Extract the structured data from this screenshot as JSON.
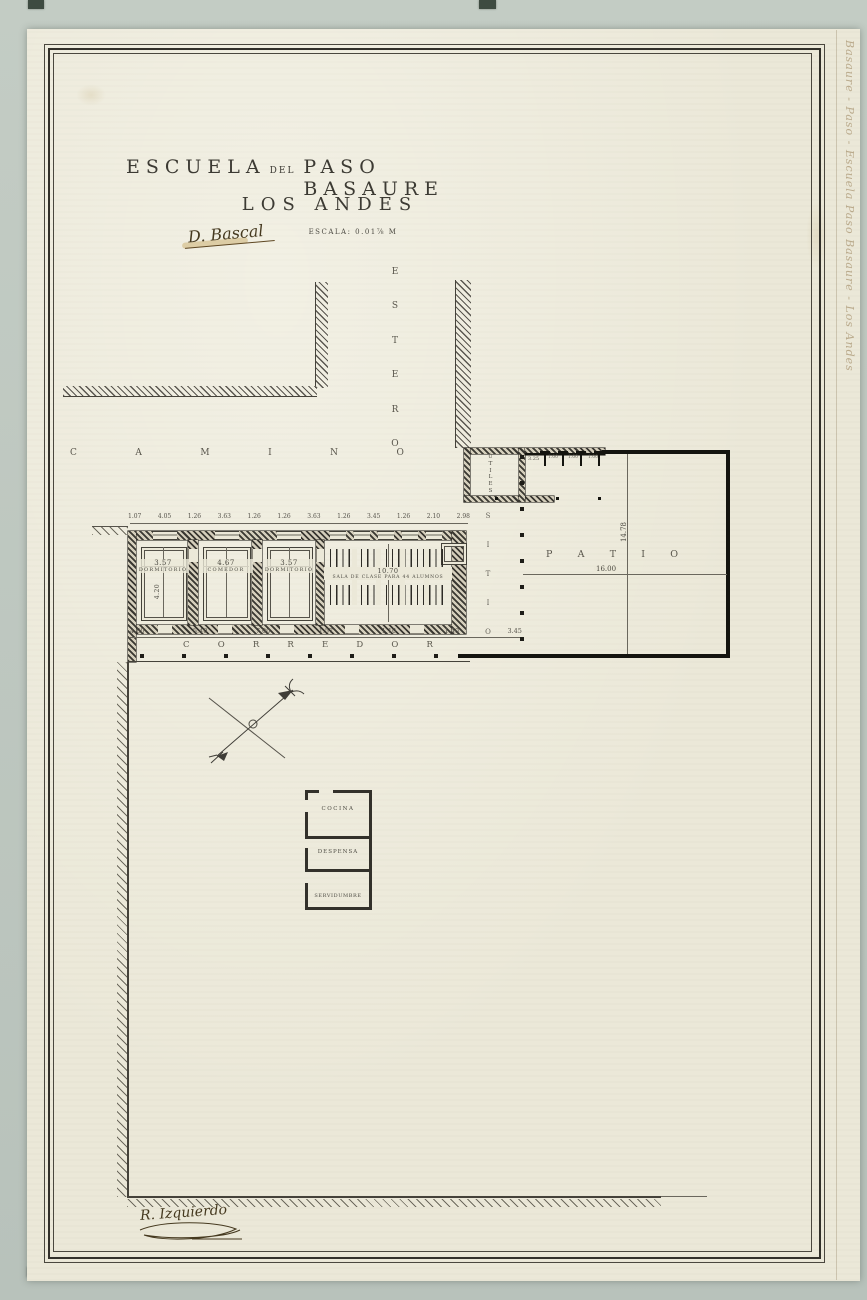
{
  "colors": {
    "paper": "#ebe8d8",
    "mat": "#bdc7c0",
    "ink": "#32302a",
    "sepia": "#7a5c2e"
  },
  "titles": {
    "line1_a": "ESCUELA",
    "line1_b": "DEL",
    "line1_c": "PASO BASAURE",
    "line2": "LOS ANDES",
    "scale": "ESCALA: 0.01⅞ M"
  },
  "annotations": {
    "approval": "D. Bascal",
    "drafter": "R. Izquierdo",
    "margin_note": "Basaure  -  Paso  -  Escuela Paso Basaure  -  Los Andes"
  },
  "site_labels": {
    "road": "CAMINO",
    "stream": "ESTERO",
    "yard": "SITIO",
    "patio": "PATIO",
    "patio_width": "16.00",
    "patio_depth": "14.78",
    "utiles": "ÚTILES",
    "latrine_dim": "3.25",
    "latrine_bays": [
      "1.00",
      "1.00",
      "1.00"
    ]
  },
  "building": {
    "corridor": "CORREDOR",
    "top_dims": [
      "1.07",
      "4.05",
      "1.26",
      "3.63",
      "1.26",
      "1.26",
      "3.63",
      "1.26",
      "3.45",
      "1.26",
      "2.10",
      "2.98"
    ],
    "bottom_dims": [
      "4.80",
      "5.40",
      "7.00",
      "1.57",
      "1.10",
      "1.40",
      "3.45"
    ],
    "rooms": [
      {
        "name": "DORMITORIO",
        "width": "3.57",
        "depth": "4.20"
      },
      {
        "name": "COMEDOR",
        "width": "4.67"
      },
      {
        "name": "DORMITORIO",
        "width": "3.57"
      },
      {
        "name": "SALA DE CLASE PARA 44 ALUMNOS",
        "width": "10.70"
      }
    ]
  },
  "kitchen": {
    "rooms": [
      "COCINA",
      "DESPENSA",
      "SERVIDUMBRE"
    ]
  }
}
